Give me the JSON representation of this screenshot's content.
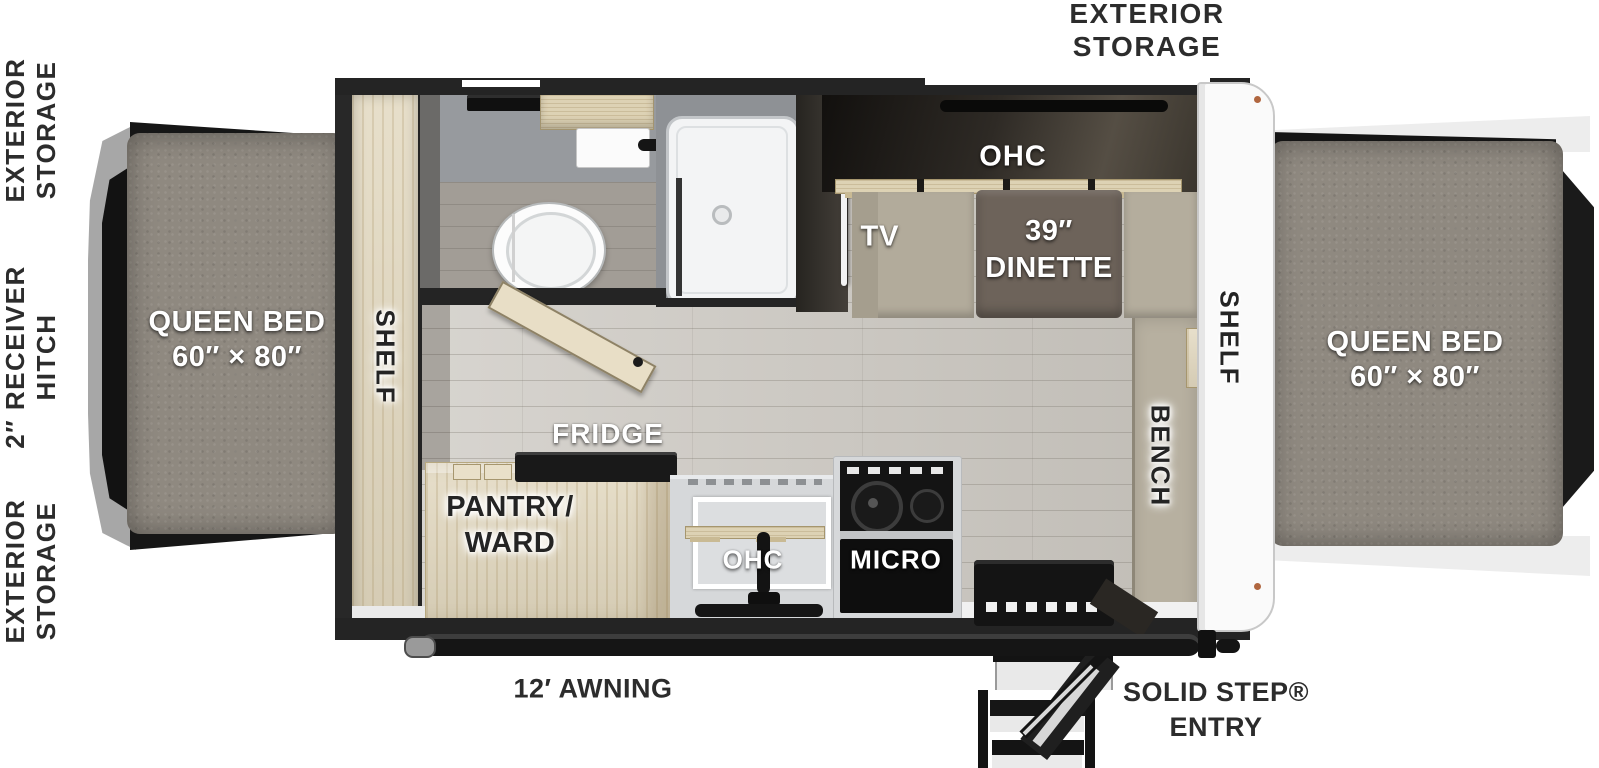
{
  "title": "Travel trailer floor plan",
  "colors": {
    "wall_dark": "#242424",
    "wood_light": "#e2d8bf",
    "mattress_gray": "#8f8980",
    "floor_gray": "#cbc7c0",
    "bench_beige": "#b4ad9d",
    "table_brown": "#6d635a",
    "appliance_black": "#141414",
    "panel_white": "#fafafa",
    "label_white": "#ffffff",
    "label_dark": "#2c2c2c"
  },
  "labels": {
    "top_storage": {
      "l1": "EXTERIOR",
      "l2": "STORAGE"
    },
    "side": {
      "g1l1": "EXTERIOR",
      "g1l2": "STORAGE",
      "g2l1": "2″ RECEIVER",
      "g2l2": "HITCH",
      "g3l1": "EXTERIOR",
      "g3l2": "STORAGE"
    },
    "bed_left": {
      "l1": "QUEEN BED",
      "l2": "60″ × 80″"
    },
    "bed_right": {
      "l1": "QUEEN BED",
      "l2": "60″ × 80″"
    },
    "shelf_left": "SHELF",
    "shelf_right": "SHELF",
    "bench": "BENCH",
    "ohc_dinette": "OHC",
    "tv": "TV",
    "dinette": {
      "l1": "39″",
      "l2": "DINETTE"
    },
    "fridge": "FRIDGE",
    "pantry": {
      "l1": "PANTRY/",
      "l2": "WARD"
    },
    "ohc_kitchen": "OHC",
    "micro": "MICRO",
    "awning": "12′ AWNING",
    "solid_step": {
      "l1": "SOLID STEP®",
      "l2": "ENTRY"
    }
  }
}
